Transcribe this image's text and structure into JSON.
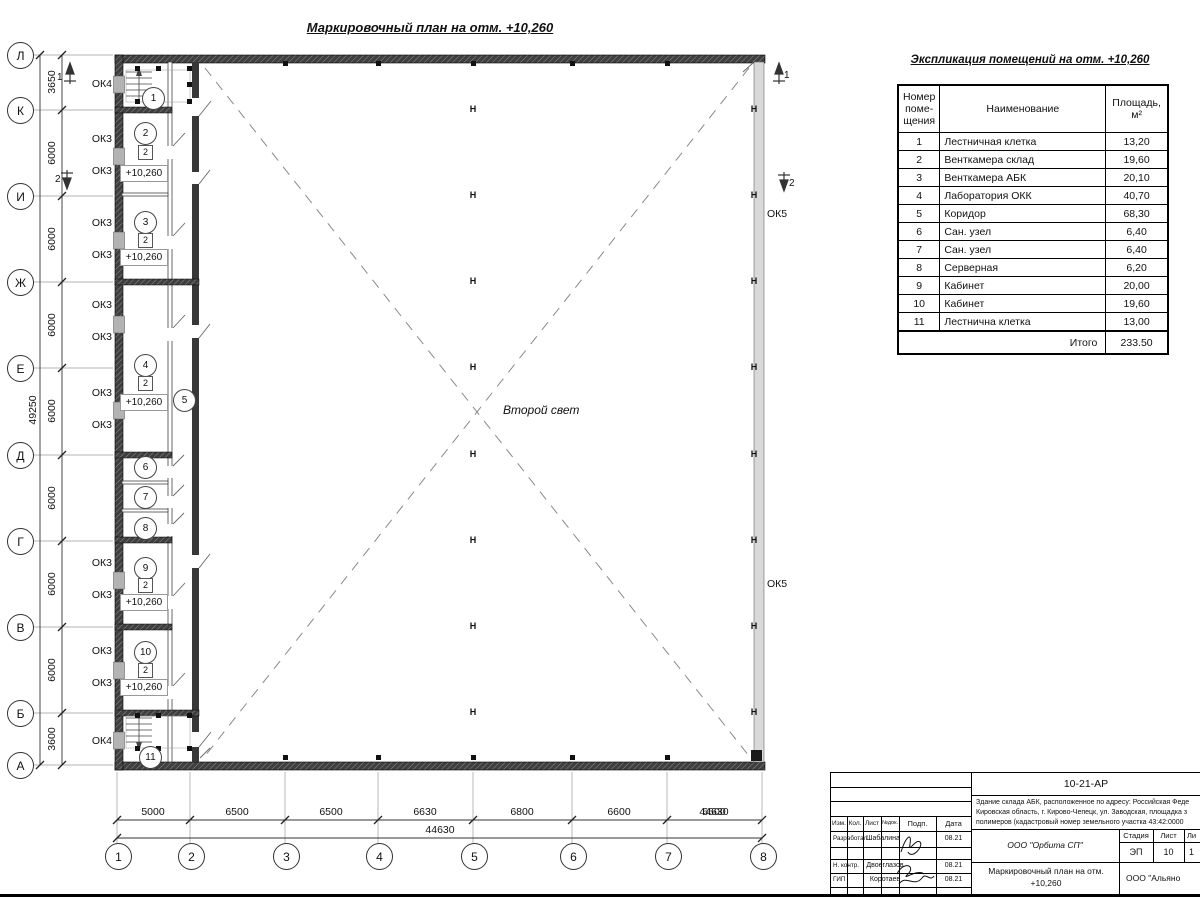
{
  "plan": {
    "title": "Маркировочный план на отм. +10,260",
    "hall_label": "Второй свет",
    "column_symbol": "H",
    "elevation_mark": "+10,260",
    "floor_type_mark": "2"
  },
  "axes": {
    "rows": [
      "Л",
      "К",
      "И",
      "Ж",
      "Е",
      "Д",
      "Г",
      "В",
      "Б",
      "А"
    ],
    "cols": [
      "1",
      "2",
      "3",
      "4",
      "5",
      "6",
      "7",
      "8"
    ],
    "row_dims": [
      "3650",
      "6000",
      "6000",
      "6000",
      "6000",
      "6000",
      "6000",
      "6000",
      "3600"
    ],
    "row_total": "49250",
    "col_dims": [
      "5000",
      "6500",
      "6500",
      "6630",
      "6800",
      "6600",
      "6600"
    ],
    "col_total": "44630"
  },
  "windows": {
    "ok3": "ОК3",
    "ok4": "ОК4",
    "ok5": "ОК5"
  },
  "sections": {
    "s1": "1",
    "s2": "2"
  },
  "rooms": {
    "marks": [
      "1",
      "2",
      "3",
      "4",
      "5",
      "6",
      "7",
      "8",
      "9",
      "10",
      "11"
    ]
  },
  "explication": {
    "title": "Экспликация помещений на отм. +10,260",
    "col_number": "Номер\nпоме-\nщения",
    "col_name": "Наименование",
    "col_area": "Площадь,\nм²",
    "rows": [
      {
        "num": "1",
        "name": "Лестничная клетка",
        "area": "13,20"
      },
      {
        "num": "2",
        "name": "Венткамера склад",
        "area": "19,60"
      },
      {
        "num": "3",
        "name": "Венткамера АБК",
        "area": "20,10"
      },
      {
        "num": "4",
        "name": "Лаборатория ОКК",
        "area": "40,70"
      },
      {
        "num": "5",
        "name": "Коридор",
        "area": "68,30"
      },
      {
        "num": "6",
        "name": "Сан. узел",
        "area": "6,40"
      },
      {
        "num": "7",
        "name": "Сан. узел",
        "area": "6,40"
      },
      {
        "num": "8",
        "name": "Серверная",
        "area": "6,20"
      },
      {
        "num": "9",
        "name": "Кабинет",
        "area": "20,00"
      },
      {
        "num": "10",
        "name": "Кабинет",
        "area": "19,60"
      },
      {
        "num": "11",
        "name": "Лестнична клетка",
        "area": "13,00"
      }
    ],
    "total_label": "Итого",
    "total_value": "233.50"
  },
  "titleblock": {
    "doc_number": "10-21-АР",
    "address_line1": "Здание склада АБК, расположенное по адресу: Российская Феде",
    "address_line2": "Кировская область, г. Кирово-Чепецк, ул. Заводская, площадка з",
    "address_line3": "полимеров (кадастровый номер земельного участка 43:42:0000",
    "col_izm": "Изм.",
    "col_kol": "Кол.",
    "col_list": "Лист",
    "col_ndoc": "№док.",
    "col_podp": "Подп.",
    "col_data": "Дата",
    "row1_role": "Разработал",
    "row1_name": "Шабалина",
    "row1_date": "08.21",
    "row2_role": "Н. контр.",
    "row2_name": "Двоеглазов",
    "row2_date": "08.21",
    "row3_role": "ГИП",
    "row3_name": "Коротаев",
    "row3_date": "08.21",
    "designer": "ООО \"Орбита СП\"",
    "stage_label": "Стадия",
    "sheet_label": "Лист",
    "sheets_label": "Ли",
    "stage": "ЭП",
    "sheet": "10",
    "sheets": "1",
    "drawing_name": "Маркировочный план на отм. +10,260",
    "client": "ООО \"Альяно"
  }
}
